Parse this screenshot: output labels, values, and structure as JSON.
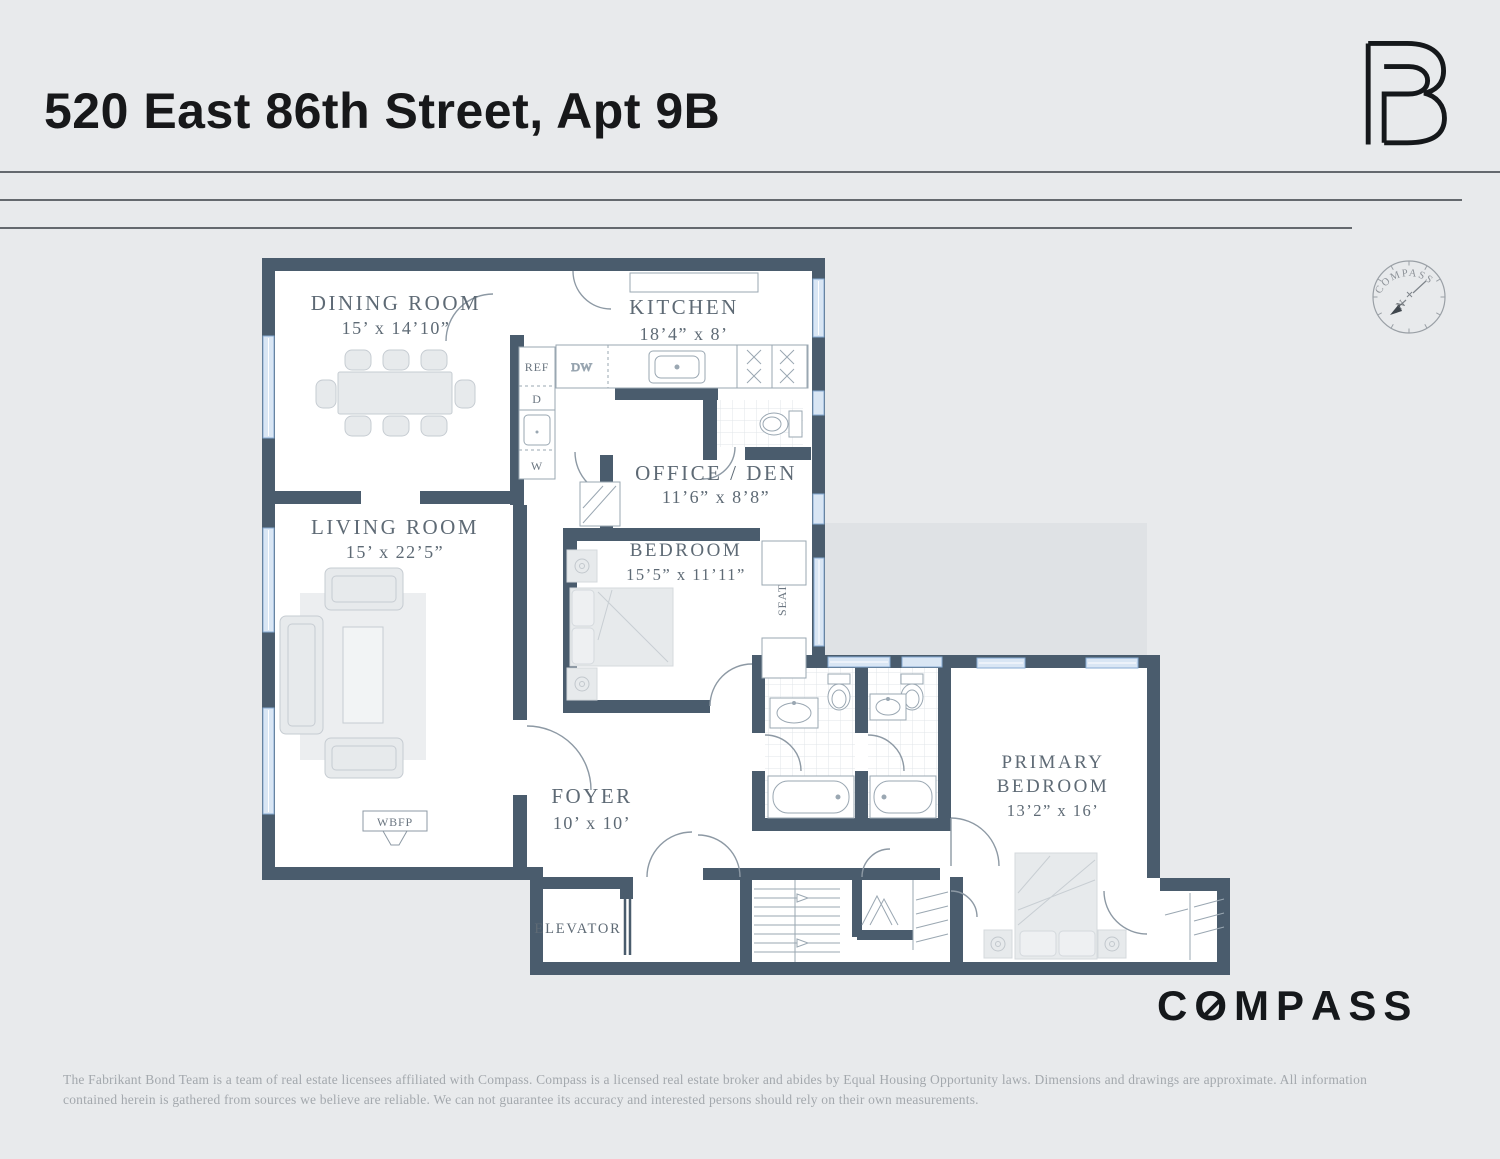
{
  "header": {
    "title": "520 East 86th Street, Apt 9B"
  },
  "compass_rose": {
    "label": "COMPASS",
    "north": "N"
  },
  "rooms": {
    "dining": {
      "name": "DINING ROOM",
      "dims": "15’ x 14’10”"
    },
    "kitchen": {
      "name": "KITCHEN",
      "dims": "18’4” x 8’"
    },
    "office": {
      "name": "OFFICE / DEN",
      "dims": "11’6” x 8’8”"
    },
    "living": {
      "name": "LIVING ROOM",
      "dims": "15’ x 22’5”"
    },
    "bedroom": {
      "name": "BEDROOM",
      "dims": "15’5” x 11’11”"
    },
    "foyer": {
      "name": "FOYER",
      "dims": "10’ x 10’"
    },
    "primary": {
      "name_line1": "PRIMARY",
      "name_line2": "BEDROOM",
      "dims": "13’2” x 16’"
    },
    "elevator": {
      "name": "ELEVATOR"
    }
  },
  "fixture_labels": {
    "ref": "REF",
    "dryer": "D",
    "washer": "W",
    "dishwasher": "DW",
    "fireplace": "WBFP",
    "seat": "SEAT"
  },
  "footer": {
    "compass_wordmark": "COMPASS",
    "disclaimer_line1": "The Fabrikant Bond Team is a team of real estate licensees affiliated with Compass. Compass is a licensed real estate broker and abides by Equal Housing Opportunity laws. Dimensions and drawings are approximate. All information",
    "disclaimer_line2": "contained herein is gathered from sources we believe are reliable. We can not guarantee its accuracy and interested persons should rely on their own measurements."
  },
  "colors": {
    "wall": "#4a5c6d",
    "window": "#86abd3",
    "background": "#e8eaec"
  }
}
